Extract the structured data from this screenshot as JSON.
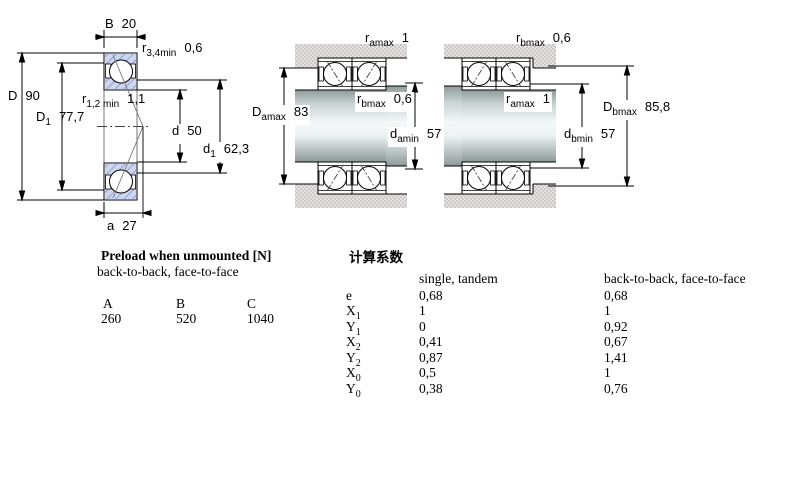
{
  "drawing": {
    "dims": {
      "B": {
        "sym": "B",
        "sub": "",
        "val": "20"
      },
      "r34": {
        "sym": "r",
        "sub": "3,4min",
        "val": "0,6"
      },
      "D": {
        "sym": "D",
        "sub": "",
        "val": "90"
      },
      "D1": {
        "sym": "D",
        "sub": "1",
        "val": "77,7"
      },
      "r12": {
        "sym": "r",
        "sub": "1,2 min",
        "val": "1,1"
      },
      "d": {
        "sym": "d",
        "sub": "",
        "val": "50"
      },
      "d1": {
        "sym": "d",
        "sub": "1",
        "val": "62,3"
      },
      "a": {
        "sym": "a",
        "sub": "",
        "val": "27"
      },
      "arr1_ramax": {
        "sym": "r",
        "sub": "amax",
        "val": "1"
      },
      "arr1_Damax": {
        "sym": "D",
        "sub": "amax",
        "val": "83"
      },
      "arr1_rbmax": {
        "sym": "r",
        "sub": "bmax",
        "val": "0,6"
      },
      "arr1_damin": {
        "sym": "d",
        "sub": "amin",
        "val": "57"
      },
      "arr2_rbmax": {
        "sym": "r",
        "sub": "bmax",
        "val": "0,6"
      },
      "arr2_ramax": {
        "sym": "r",
        "sub": "amax",
        "val": "1"
      },
      "arr2_Dbmax": {
        "sym": "D",
        "sub": "bmax",
        "val": "85,8"
      },
      "arr2_dbmin": {
        "sym": "d",
        "sub": "bmin",
        "val": "57"
      }
    },
    "colors": {
      "ring_hatch_fill": "#ccd6ee",
      "ring_hatch_line": "#8495cc",
      "housing_gray": "#e2dfdf",
      "line_black": "#000000"
    }
  },
  "preload": {
    "title": "Preload when unmounted [N]",
    "subtitle": "back-to-back, face-to-face",
    "columns": [
      "A",
      "B",
      "C"
    ],
    "values": [
      "260",
      "520",
      "1040"
    ]
  },
  "factors": {
    "title": "计算系数",
    "col_single": "single, tandem",
    "col_btb": "back-to-back, face-to-face",
    "rows": [
      {
        "sym": "e",
        "sub": "",
        "single": "0,68",
        "btb": "0,68"
      },
      {
        "sym": "X",
        "sub": "1",
        "single": "1",
        "btb": "1"
      },
      {
        "sym": "Y",
        "sub": "1",
        "single": "0",
        "btb": "0,92"
      },
      {
        "sym": "X",
        "sub": "2",
        "single": "0,41",
        "btb": "0,67"
      },
      {
        "sym": "Y",
        "sub": "2",
        "single": "0,87",
        "btb": "1,41"
      },
      {
        "sym": "X",
        "sub": "0",
        "single": "0,5",
        "btb": "1"
      },
      {
        "sym": "Y",
        "sub": "0",
        "single": "0,38",
        "btb": "0,76"
      }
    ]
  }
}
